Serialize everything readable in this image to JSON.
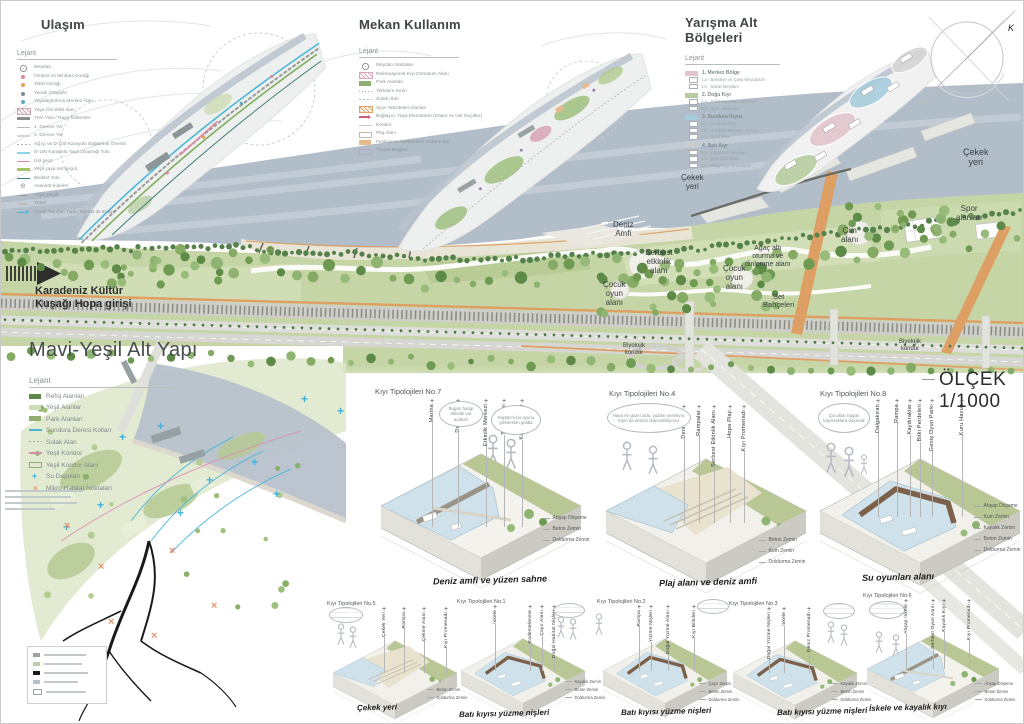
{
  "panels": {
    "ulasim": {
      "title": "Ulaşım",
      "legend_title": "Lejant",
      "items": [
        {
          "sw": "sym-circle",
          "color": "#8a8f92",
          "label": "Meydan"
        },
        {
          "sw": "dot",
          "color": "#d98a9a",
          "label": "Otobüs ve Minibüs Durağı"
        },
        {
          "sw": "dot",
          "color": "#e2a25e",
          "label": "Taksi Durağı"
        },
        {
          "sw": "dot",
          "color": "#7f8c95",
          "label": "Yeraltı Otoparkı"
        },
        {
          "sw": "dot",
          "color": "#5fa8c7",
          "label": "Yayalaştırılmış Merkez Alan"
        },
        {
          "sw": "hatch",
          "color": "#c9a6b4",
          "label": "Yaya Öncelikli Alan"
        },
        {
          "sw": "line-thick",
          "color": "#8c8c8c",
          "label": "Tren Yolu / Raylı Sistemler"
        },
        {
          "sw": "line",
          "color": "#b9b9b9",
          "label": "1. Derece Yol"
        },
        {
          "sw": "line",
          "color": "#d4d4d4",
          "label": "2. Derece Yol"
        },
        {
          "sw": "dashes",
          "color": "#b0b0b0",
          "label": "Ağ içi ve D-100 Karayolu Bağlantısı Önerisi"
        },
        {
          "sw": "line",
          "color": "#8fd4e8",
          "label": "D-100 Karayolu Yaya Dinamiği Yolu"
        },
        {
          "sw": "line",
          "color": "#e08aa8",
          "label": "Üst geçit"
        },
        {
          "sw": "line-thick",
          "color": "#a4c46a",
          "label": "Yeşil yaya üst geçidi"
        },
        {
          "sw": "line",
          "color": "#3e7d78",
          "label": "Bisiklet Yolu"
        },
        {
          "sw": "sym-elev",
          "color": "#9a9a9a",
          "label": "Asansör kuleleri"
        },
        {
          "sw": "tick",
          "color": "#9a9a9a",
          "label": "Yaya geçidi"
        },
        {
          "sw": "tick",
          "color": "#bdbdbd",
          "label": "Tünel"
        },
        {
          "sw": "arrow",
          "color": "#49b6d6",
          "label": "Kırsal Alandan Toplu Taşıma ile Erişim"
        }
      ]
    },
    "mekan": {
      "title": "Mekan Kullanım",
      "legend_title": "Lejant",
      "items": [
        {
          "sw": "sym-circle",
          "color": "#8a8f92",
          "label": "Meydan Noktaları"
        },
        {
          "sw": "hatch",
          "color": "#d8a7b8",
          "label": "Rekreasyonel Kıyı Dönüşüm Alanı"
        },
        {
          "sw": "box",
          "color": "#8fae6f",
          "label": "Park Alanları"
        },
        {
          "sw": "dots-line",
          "color": "#b0b0b0",
          "label": "Yerleşim Sınırı"
        },
        {
          "sw": "dashes",
          "color": "#9ec3d8",
          "label": "Sulak Alan"
        },
        {
          "sw": "hatch",
          "color": "#e2a25e",
          "label": "Spor Aktiviteleri Alanları"
        },
        {
          "sw": "arrow",
          "color": "#c75f7d",
          "label": "Bağlayıcı Yaya Elemanları (Köprü ve Üst Geçitler)"
        },
        {
          "sw": "line",
          "color": "#c9c9c9",
          "label": "Koridor"
        },
        {
          "sw": "box-outline",
          "color": "#c9b8a2",
          "label": "Plaj Alanı"
        },
        {
          "sw": "box",
          "color": "#e8b98b",
          "label": "Festival ve Geleneksel Kullanımlar"
        },
        {
          "sw": "box-outline",
          "color": "#b8a7c9",
          "label": "Ticaret Bölgesi"
        }
      ]
    },
    "yarisma": {
      "title": "Yarışma Alt Bölgeleri",
      "legend_title": "Lejant",
      "groups": [
        {
          "color": "#e2c4cb",
          "label": "1. Merkez Bölge",
          "subs": [
            "1.a - Belediye ve Çarşı Meydanları",
            "1.b - Sanat Meydanı"
          ]
        },
        {
          "color": "#b5cc9e",
          "label": "2. Doğu Kıyı",
          "subs": [
            "2.a - Sahil Karşılama Merkezi",
            "2.b - Spor Aktiviteleri"
          ]
        },
        {
          "color": "#a3cbdc",
          "label": "3. Sundura Kıyısı",
          "subs": [
            "3.a - Sundura Plajı",
            "3.b - Sundura Meydanı ve Kıyı",
            "3.c - Sahil Yolu"
          ]
        },
        {
          "color": "#cccccc",
          "label": "4. Batı Kıyı",
          "subs": [
            "4.a - Karşılama Meydanı",
            "4.b - Spor Etkinlikleri",
            "4.c - Bölge Kıyı ve Gelişimi"
          ]
        }
      ]
    },
    "mavi": {
      "title": "Mavi-Yeşil Alt Yapı",
      "legend_title": "Lejant",
      "items": [
        {
          "sw": "box",
          "color": "#5f8a4a",
          "label": "Refüj Alanları"
        },
        {
          "sw": "box",
          "color": "#cfdcb5",
          "label": "Yeşil Alanlar"
        },
        {
          "sw": "box",
          "color": "#8fae6f",
          "label": "Park Alanları"
        },
        {
          "sw": "line",
          "color": "#49b6d6",
          "label": "Sundura Deresi Kolları"
        },
        {
          "sw": "dashes",
          "color": "#9ab0b8",
          "label": "Sulak Alan"
        },
        {
          "sw": "line",
          "color": "#d98ab0",
          "label": "Yeşil Koridor"
        },
        {
          "sw": "box-outline",
          "color": "#8fae6f",
          "label": "Yeşil Koridor Alanı"
        },
        {
          "sw": "plus",
          "color": "#3fb1d8",
          "label": "Su Depoları"
        },
        {
          "sw": "xmark",
          "color": "#e8956a",
          "label": "Mikro Habitat Noktaları"
        }
      ],
      "map_marks": {
        "crosses": [
          {
            "x": 118,
            "y": 432
          },
          {
            "x": 156,
            "y": 421
          },
          {
            "x": 300,
            "y": 394
          },
          {
            "x": 336,
            "y": 406
          },
          {
            "x": 250,
            "y": 457
          },
          {
            "x": 272,
            "y": 489
          },
          {
            "x": 205,
            "y": 475
          },
          {
            "x": 96,
            "y": 500
          },
          {
            "x": 62,
            "y": 522
          },
          {
            "x": 176,
            "y": 508
          }
        ],
        "xmarks": [
          {
            "x": 63,
            "y": 521
          },
          {
            "x": 97,
            "y": 562
          },
          {
            "x": 168,
            "y": 546
          },
          {
            "x": 210,
            "y": 601
          },
          {
            "x": 107,
            "y": 617
          },
          {
            "x": 150,
            "y": 631
          }
        ]
      }
    }
  },
  "masterplan": {
    "entrance": "Karadeniz Kültür\nKuşağı Hopa girişi",
    "scale_label": "ÖLÇEK 1/1000",
    "north_label": "K",
    "labels": [
      {
        "text": "Çekek\nyeri",
        "x": 962,
        "y": 146,
        "fs": 9
      },
      {
        "text": "Çekek\nyeri",
        "x": 680,
        "y": 173,
        "fs": 8
      },
      {
        "text": "Deniz\nAmfi",
        "x": 612,
        "y": 220,
        "fs": 8
      },
      {
        "text": "Serbest\netkinlik\nalanı",
        "x": 644,
        "y": 248,
        "fs": 8
      },
      {
        "text": "Çocuk\noyun\nalanı",
        "x": 602,
        "y": 280,
        "fs": 8
      },
      {
        "text": "Çocuk\noyun\nalanı",
        "x": 722,
        "y": 264,
        "fs": 8
      },
      {
        "text": "Ağaç altı\noturma ve\ndinlenme alanı",
        "x": 744,
        "y": 244,
        "fs": 7
      },
      {
        "text": "Set\nBahçeleri",
        "x": 762,
        "y": 292,
        "fs": 7.5
      },
      {
        "text": "Çim\nalanı",
        "x": 840,
        "y": 226,
        "fs": 8
      },
      {
        "text": "Spor\nalanları",
        "x": 955,
        "y": 204,
        "fs": 8
      },
      {
        "text": "Biyolojik\nkoridor",
        "x": 622,
        "y": 342,
        "fs": 6
      },
      {
        "text": "Biyolojik\nkoridor",
        "x": 898,
        "y": 338,
        "fs": 6
      }
    ]
  },
  "typologies": {
    "large": [
      {
        "title": "Kıyı Tipolojileri No.7",
        "labels": [
          {
            "t": "Marina",
            "x": 52
          },
          {
            "t": "Deniz Amfi",
            "x": 78
          },
          {
            "t": "Etkinlik Merkezi",
            "x": 106
          },
          {
            "t": "Tören Alanı",
            "x": 124
          },
          {
            "t": "Kayalık Sular",
            "x": 142
          }
        ],
        "bubbles": [
          {
            "t": "Bugün hangi etkinlik var acaba?",
            "x": 64,
            "y": 16,
            "w": 44,
            "h": 26
          },
          {
            "t": "Kaptan'a bu oyunu gösterelim galiba",
            "x": 116,
            "y": 20,
            "w": 50,
            "h": 30
          }
        ],
        "materials": [
          "Ahşap Döşeme",
          "Beton Zemin",
          "Doldurma Zemin"
        ],
        "caption": "Deniz amfi ve yüzen sahne"
      },
      {
        "title": "Kıyı Tipolojileri No.4",
        "labels": [
          {
            "t": "Deniz Amfi",
            "x": 78
          },
          {
            "t": "Rampalar",
            "x": 93
          },
          {
            "t": "Serbest Etkinlik Alanı",
            "x": 108
          },
          {
            "t": "Hopa Plajı",
            "x": 124
          },
          {
            "t": "Kıyı Promenadı",
            "x": 138
          }
        ],
        "bubbles": [
          {
            "t": "Hava ne güzel oldu; yazları serinliyor, kışın da denize dokunabiliyoruz",
            "x": 6,
            "y": 14,
            "w": 84,
            "h": 30
          }
        ],
        "materials": [
          "Beton Zemin",
          "Kum Zemin",
          "Doldurma Zemin"
        ],
        "caption": "Plaj alanı ve deniz amfi"
      },
      {
        "title": "Kıyı Tipolojileri No.8",
        "labels": [
          {
            "t": "Dalgakıran",
            "x": 57
          },
          {
            "t": "Rampa",
            "x": 76
          },
          {
            "t": "Kaydıraklar",
            "x": 89
          },
          {
            "t": "Bitki Perdeleri",
            "x": 99
          },
          {
            "t": "Geniş Oyun Parkı",
            "x": 111
          },
          {
            "t": "Kuru Havuz",
            "x": 141
          }
        ],
        "bubbles": [
          {
            "t": "Çocuklar bugün kaydıraklara doyacak",
            "x": 2,
            "y": 16,
            "w": 52,
            "h": 30
          }
        ],
        "materials": [
          "Ahşap Döşeme",
          "Kum Zemin",
          "Kayalık Zemin",
          "Beton Zemin",
          "Doldurma Zemin"
        ],
        "caption": "Su oyunları alanı"
      }
    ],
    "small": [
      {
        "title": "Kıyı Tipolojileri No.5",
        "labels": [
          {
            "t": "Çekek Yeri",
            "x": 56
          },
          {
            "t": "Rampa",
            "x": 76
          },
          {
            "t": "Çekme Alanı",
            "x": 96
          },
          {
            "t": "Kıyı Promenadı",
            "x": 118
          }
        ],
        "materials": [
          "Beton Zemin",
          "Doldurma Zemin"
        ],
        "caption": "Çekek yeri"
      },
      {
        "title": "Kıyı Tipolojileri No.1",
        "labels": [
          {
            "t": "İskele",
            "x": 37
          },
          {
            "t": "Kademelenme",
            "x": 72
          },
          {
            "t": "Çayır Alanı",
            "x": 84
          },
          {
            "t": "Doğal Habitat Nişleri",
            "x": 96
          }
        ],
        "materials": [
          "Kayalık Zemin",
          "Beton Zemin",
          "Doldurma Zemin"
        ],
        "caption": "Batı kıyısı yüzme nişleri"
      },
      {
        "title": "Kıyı Tipolojileri No.2",
        "labels": [
          {
            "t": "Rampa",
            "x": 41
          },
          {
            "t": "Yüzme Nişleri",
            "x": 53
          },
          {
            "t": "Doğal Yüzme Alanı",
            "x": 70
          },
          {
            "t": "Kıyı Bitkileri",
            "x": 96
          }
        ],
        "materials": [
          "Çayır Zemin",
          "Beton Zemin",
          "Doldurma Zemin"
        ],
        "caption": "Batı kıyısı yüzme nişleri"
      },
      {
        "title": "Kıyı Tipolojileri No.3",
        "labels": [
          {
            "t": "Doğal Yüzme Nişleri",
            "x": 39
          },
          {
            "t": "İskele",
            "x": 54
          },
          {
            "t": "Deniz Promenadı",
            "x": 79
          }
        ],
        "materials": [
          "Kayalık Zemin",
          "Beton Zemin",
          "Doldurma Zemin"
        ],
        "caption": "Batı kıyısı yüzme nişleri"
      },
      {
        "title": "Kıyı Tipolojileri No.6",
        "labels": [
          {
            "t": "Ahşap İskele",
            "x": 44
          },
          {
            "t": "Serbest Oyun Alanı",
            "x": 71
          },
          {
            "t": "Kayalık Kıyı",
            "x": 82
          },
          {
            "t": "Kıyı Promenadı",
            "x": 107
          }
        ],
        "materials": [
          "Ahşap Döşeme",
          "Beton Zemin",
          "Doldurma Zemin"
        ],
        "caption": "İskele ve kayalık kıyı"
      }
    ]
  }
}
